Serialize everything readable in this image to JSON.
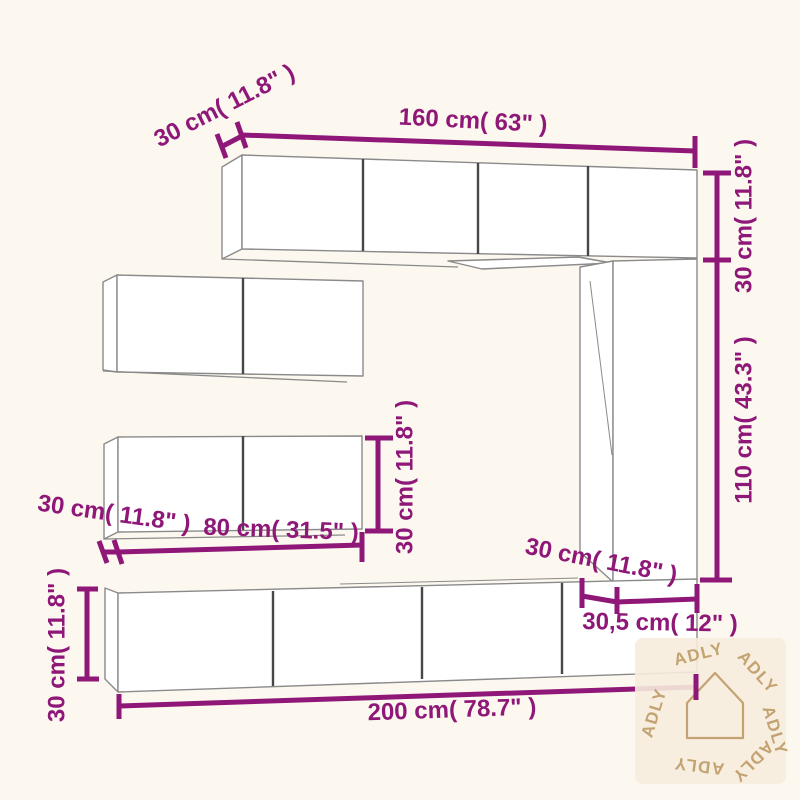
{
  "colors": {
    "background": "#fcf8ef",
    "cabinet_fill": "#ffffff",
    "cabinet_edge": "#8a8a8a",
    "door_divider": "#474747",
    "dimension": "#8e1778",
    "watermark_background": "#f7ecdd",
    "watermark_accent": "#c3a372"
  },
  "dimensions": {
    "top_depth": "30 cm( 11.8\" )",
    "top_width": "160 cm( 63\" )",
    "right_upper_height": "30 cm( 11.8\" )",
    "right_column_height": "110 cm( 43.3\" )",
    "middle_cabinet_height": "30 cm( 11.8\" )",
    "middle_depth": "30 cm( 11.8\" )",
    "middle_width": "80 cm( 31.5\" )",
    "bottom_height": "30 cm( 11.8\" )",
    "bottom_width": "200 cm( 78.7\" )",
    "column_depth": "30 cm( 11.8\" )",
    "column_width": "30,5 cm( 12\" )"
  },
  "watermark": {
    "text": "ADLY"
  }
}
